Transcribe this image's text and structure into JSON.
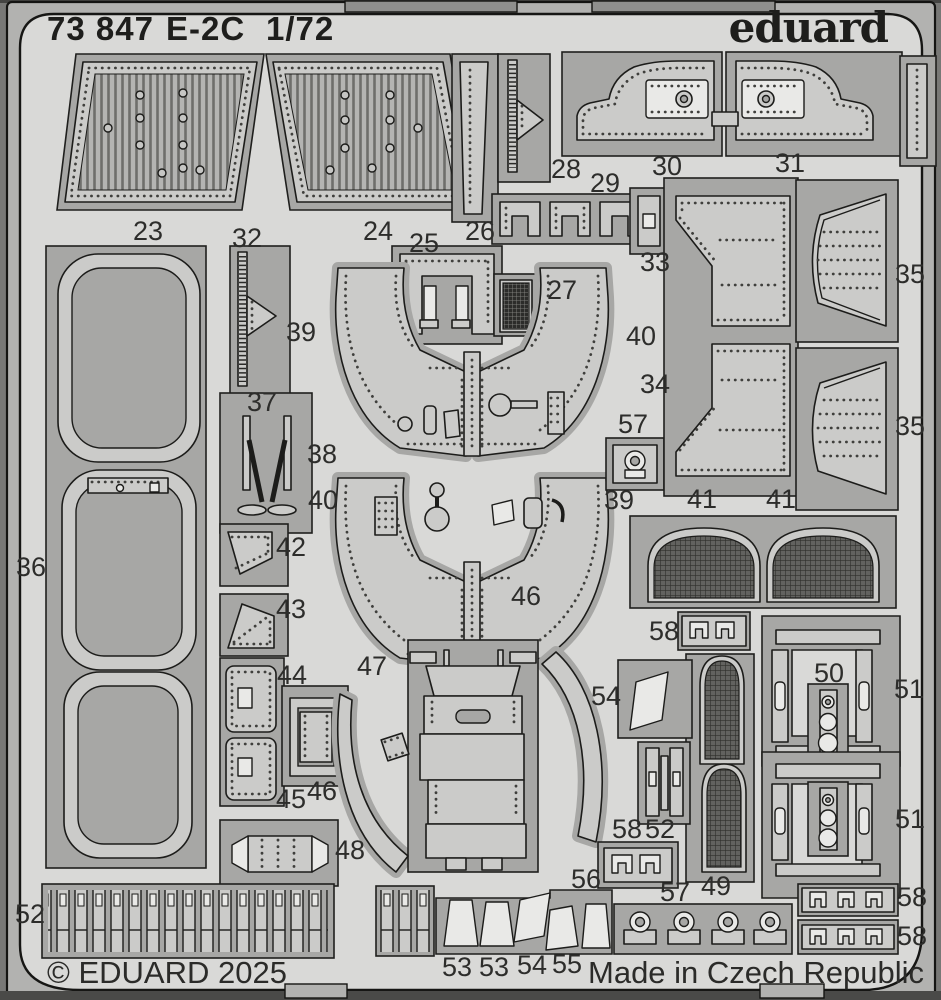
{
  "header": {
    "catalog": "73 847",
    "model": "E-2C",
    "scale": "1/72",
    "brand": "eduard"
  },
  "footer": {
    "copyright": "© EDUARD 2025",
    "origin": "Made in Czech Republic"
  },
  "colors": {
    "photo_background": "#6f6f6d",
    "fret_border": "#b2b2b0",
    "fret_field": "#d9d9d7",
    "cutout": "#a7a7a5",
    "part_metal": "#cbcbc9",
    "part_highlight": "#e9e9e7",
    "outline": "#1c1c1a",
    "text": "#2d2d2b"
  },
  "part_labels": [
    {
      "t": "23",
      "x": 148,
      "y": 240
    },
    {
      "t": "32",
      "x": 247,
      "y": 247
    },
    {
      "t": "24",
      "x": 378,
      "y": 240
    },
    {
      "t": "25",
      "x": 424,
      "y": 252
    },
    {
      "t": "26",
      "x": 480,
      "y": 240
    },
    {
      "t": "28",
      "x": 566,
      "y": 178
    },
    {
      "t": "29",
      "x": 605,
      "y": 192
    },
    {
      "t": "30",
      "x": 667,
      "y": 175
    },
    {
      "t": "31",
      "x": 790,
      "y": 172
    },
    {
      "t": "33",
      "x": 655,
      "y": 271
    },
    {
      "t": "35",
      "x": 910,
      "y": 283
    },
    {
      "t": "27",
      "x": 562,
      "y": 299
    },
    {
      "t": "39",
      "x": 301,
      "y": 341
    },
    {
      "t": "40",
      "x": 641,
      "y": 345
    },
    {
      "t": "34",
      "x": 655,
      "y": 393
    },
    {
      "t": "35",
      "x": 910,
      "y": 435
    },
    {
      "t": "37",
      "x": 262,
      "y": 411
    },
    {
      "t": "38",
      "x": 322,
      "y": 463
    },
    {
      "t": "57",
      "x": 633,
      "y": 433
    },
    {
      "t": "40",
      "x": 323,
      "y": 509
    },
    {
      "t": "39",
      "x": 619,
      "y": 509
    },
    {
      "t": "41",
      "x": 702,
      "y": 508
    },
    {
      "t": "41",
      "x": 781,
      "y": 508
    },
    {
      "t": "36",
      "x": 31,
      "y": 576
    },
    {
      "t": "42",
      "x": 291,
      "y": 556
    },
    {
      "t": "43",
      "x": 291,
      "y": 618
    },
    {
      "t": "46",
      "x": 526,
      "y": 605
    },
    {
      "t": "58",
      "x": 664,
      "y": 640
    },
    {
      "t": "44",
      "x": 292,
      "y": 684
    },
    {
      "t": "47",
      "x": 372,
      "y": 675
    },
    {
      "t": "54",
      "x": 606,
      "y": 705
    },
    {
      "t": "50",
      "x": 829,
      "y": 682
    },
    {
      "t": "51",
      "x": 909,
      "y": 698
    },
    {
      "t": "45",
      "x": 291,
      "y": 808
    },
    {
      "t": "46",
      "x": 322,
      "y": 800
    },
    {
      "t": "48",
      "x": 350,
      "y": 859
    },
    {
      "t": "51",
      "x": 910,
      "y": 828
    },
    {
      "t": "49",
      "x": 716,
      "y": 895
    },
    {
      "t": "58",
      "x": 627,
      "y": 838
    },
    {
      "t": "52",
      "x": 660,
      "y": 838
    },
    {
      "t": "56",
      "x": 586,
      "y": 888
    },
    {
      "t": "57",
      "x": 675,
      "y": 901
    },
    {
      "t": "58",
      "x": 912,
      "y": 906
    },
    {
      "t": "58",
      "x": 912,
      "y": 945
    },
    {
      "t": "52",
      "x": 30,
      "y": 923
    },
    {
      "t": "53",
      "x": 457,
      "y": 976
    },
    {
      "t": "53",
      "x": 494,
      "y": 976
    },
    {
      "t": "54",
      "x": 532,
      "y": 974
    },
    {
      "t": "55",
      "x": 567,
      "y": 973
    }
  ]
}
